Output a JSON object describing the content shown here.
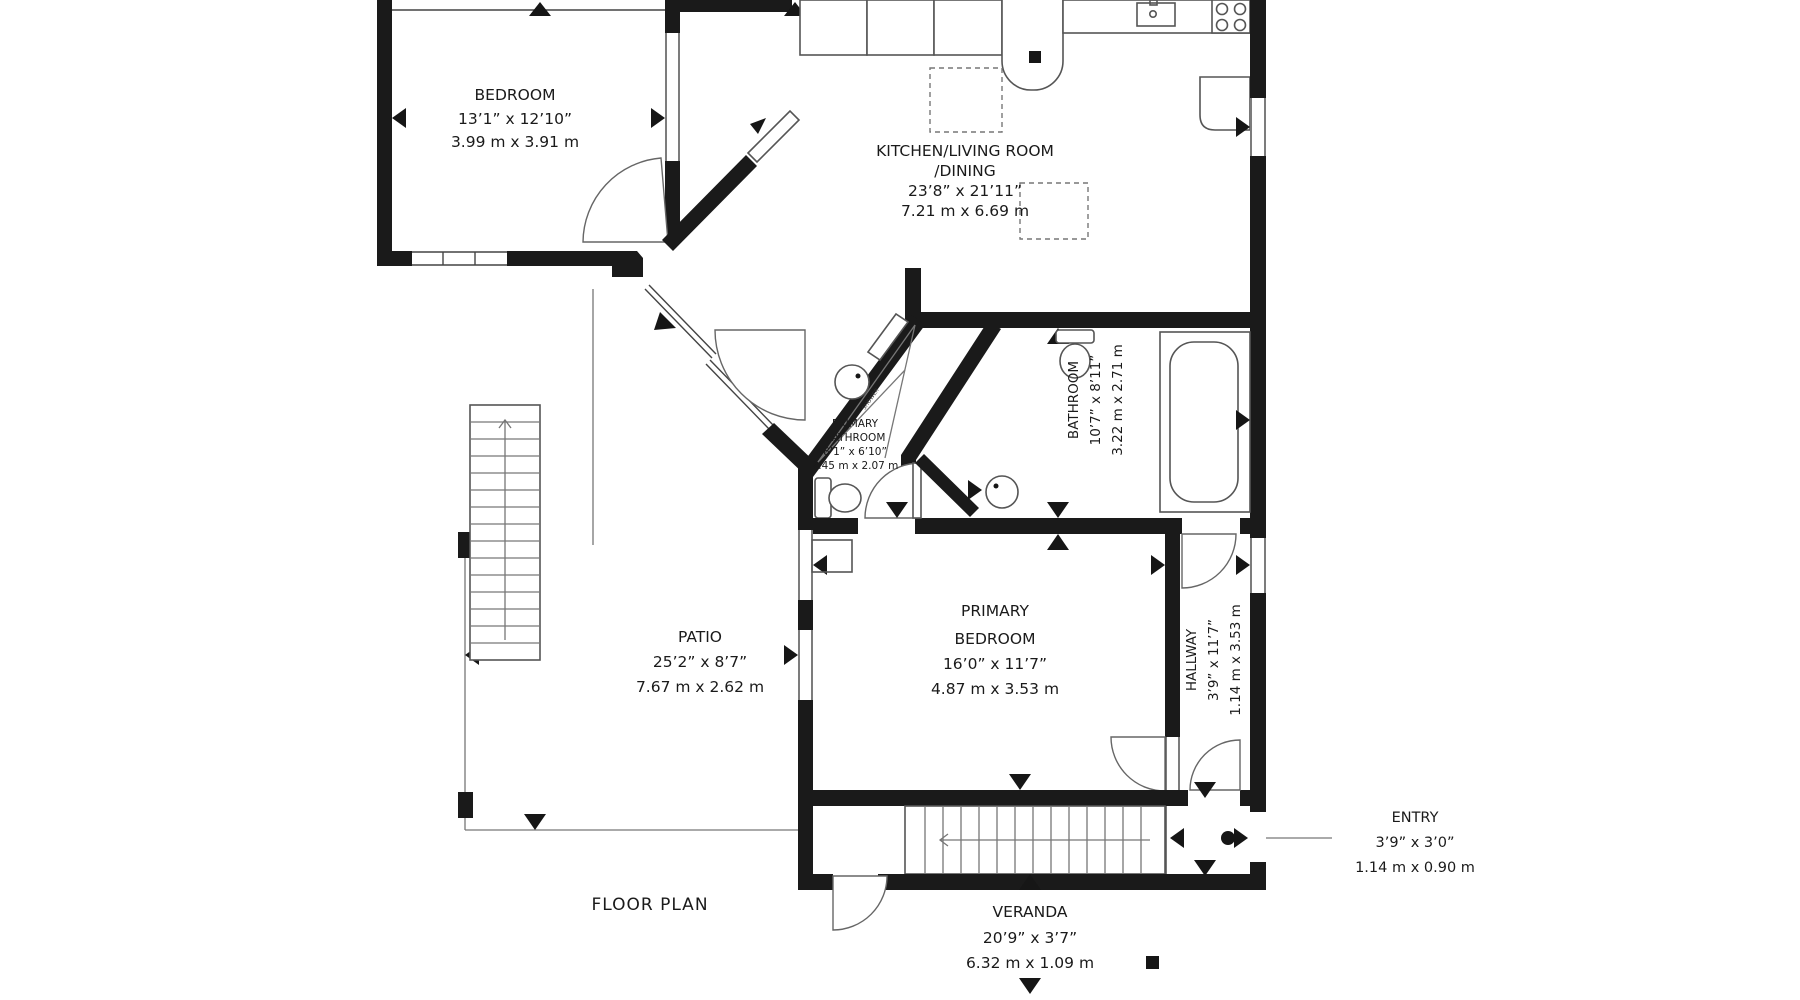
{
  "colors": {
    "background": "#ffffff",
    "walls": "#1a1a1a",
    "thin_lines": "#555555",
    "text": "#1a1a1a"
  },
  "title": {
    "label": "FLOOR PLAN"
  },
  "rooms": [
    {
      "id": "bedroom",
      "name": "BEDROOM",
      "imperial": "13’1” x 12’10”",
      "metric": "3.99 m x 3.91 m"
    },
    {
      "id": "kitchen-living",
      "name": "KITCHEN/LIVING ROOM",
      "name2": "/DINING",
      "imperial": "23’8” x 21’11”",
      "metric": "7.21 m x 6.69 m"
    },
    {
      "id": "primary-bathroom",
      "name": "PRIMARY",
      "name2": "BATHROOM",
      "imperial": "8’1” x 6’10”",
      "metric": "2.45 m x 2.07 m"
    },
    {
      "id": "bathroom",
      "name": "BATHROOM",
      "imperial": "10’7” x 8’11”",
      "metric": "3.22 m x 2.71 m"
    },
    {
      "id": "patio",
      "name": "PATIO",
      "imperial": "25’2” x 8’7”",
      "metric": "7.67 m x 2.62 m"
    },
    {
      "id": "primary-bedroom",
      "name": "PRIMARY",
      "name2": "BEDROOM",
      "imperial": "16’0” x 11’7”",
      "metric": "4.87 m x 3.53 m"
    },
    {
      "id": "hallway",
      "name": "HALLWAY",
      "imperial": "3’9” x 11’7”",
      "metric": "1.14 m x 3.53 m"
    },
    {
      "id": "entry",
      "name": "ENTRY",
      "imperial": "3’9” x 3’0”",
      "metric": "1.14 m x 0.90 m"
    },
    {
      "id": "veranda",
      "name": "VERANDA",
      "imperial": "20’9” x 3’7”",
      "metric": "6.32 m x 1.09 m"
    }
  ],
  "fixtures": {
    "shower_label": "SHOWER"
  }
}
